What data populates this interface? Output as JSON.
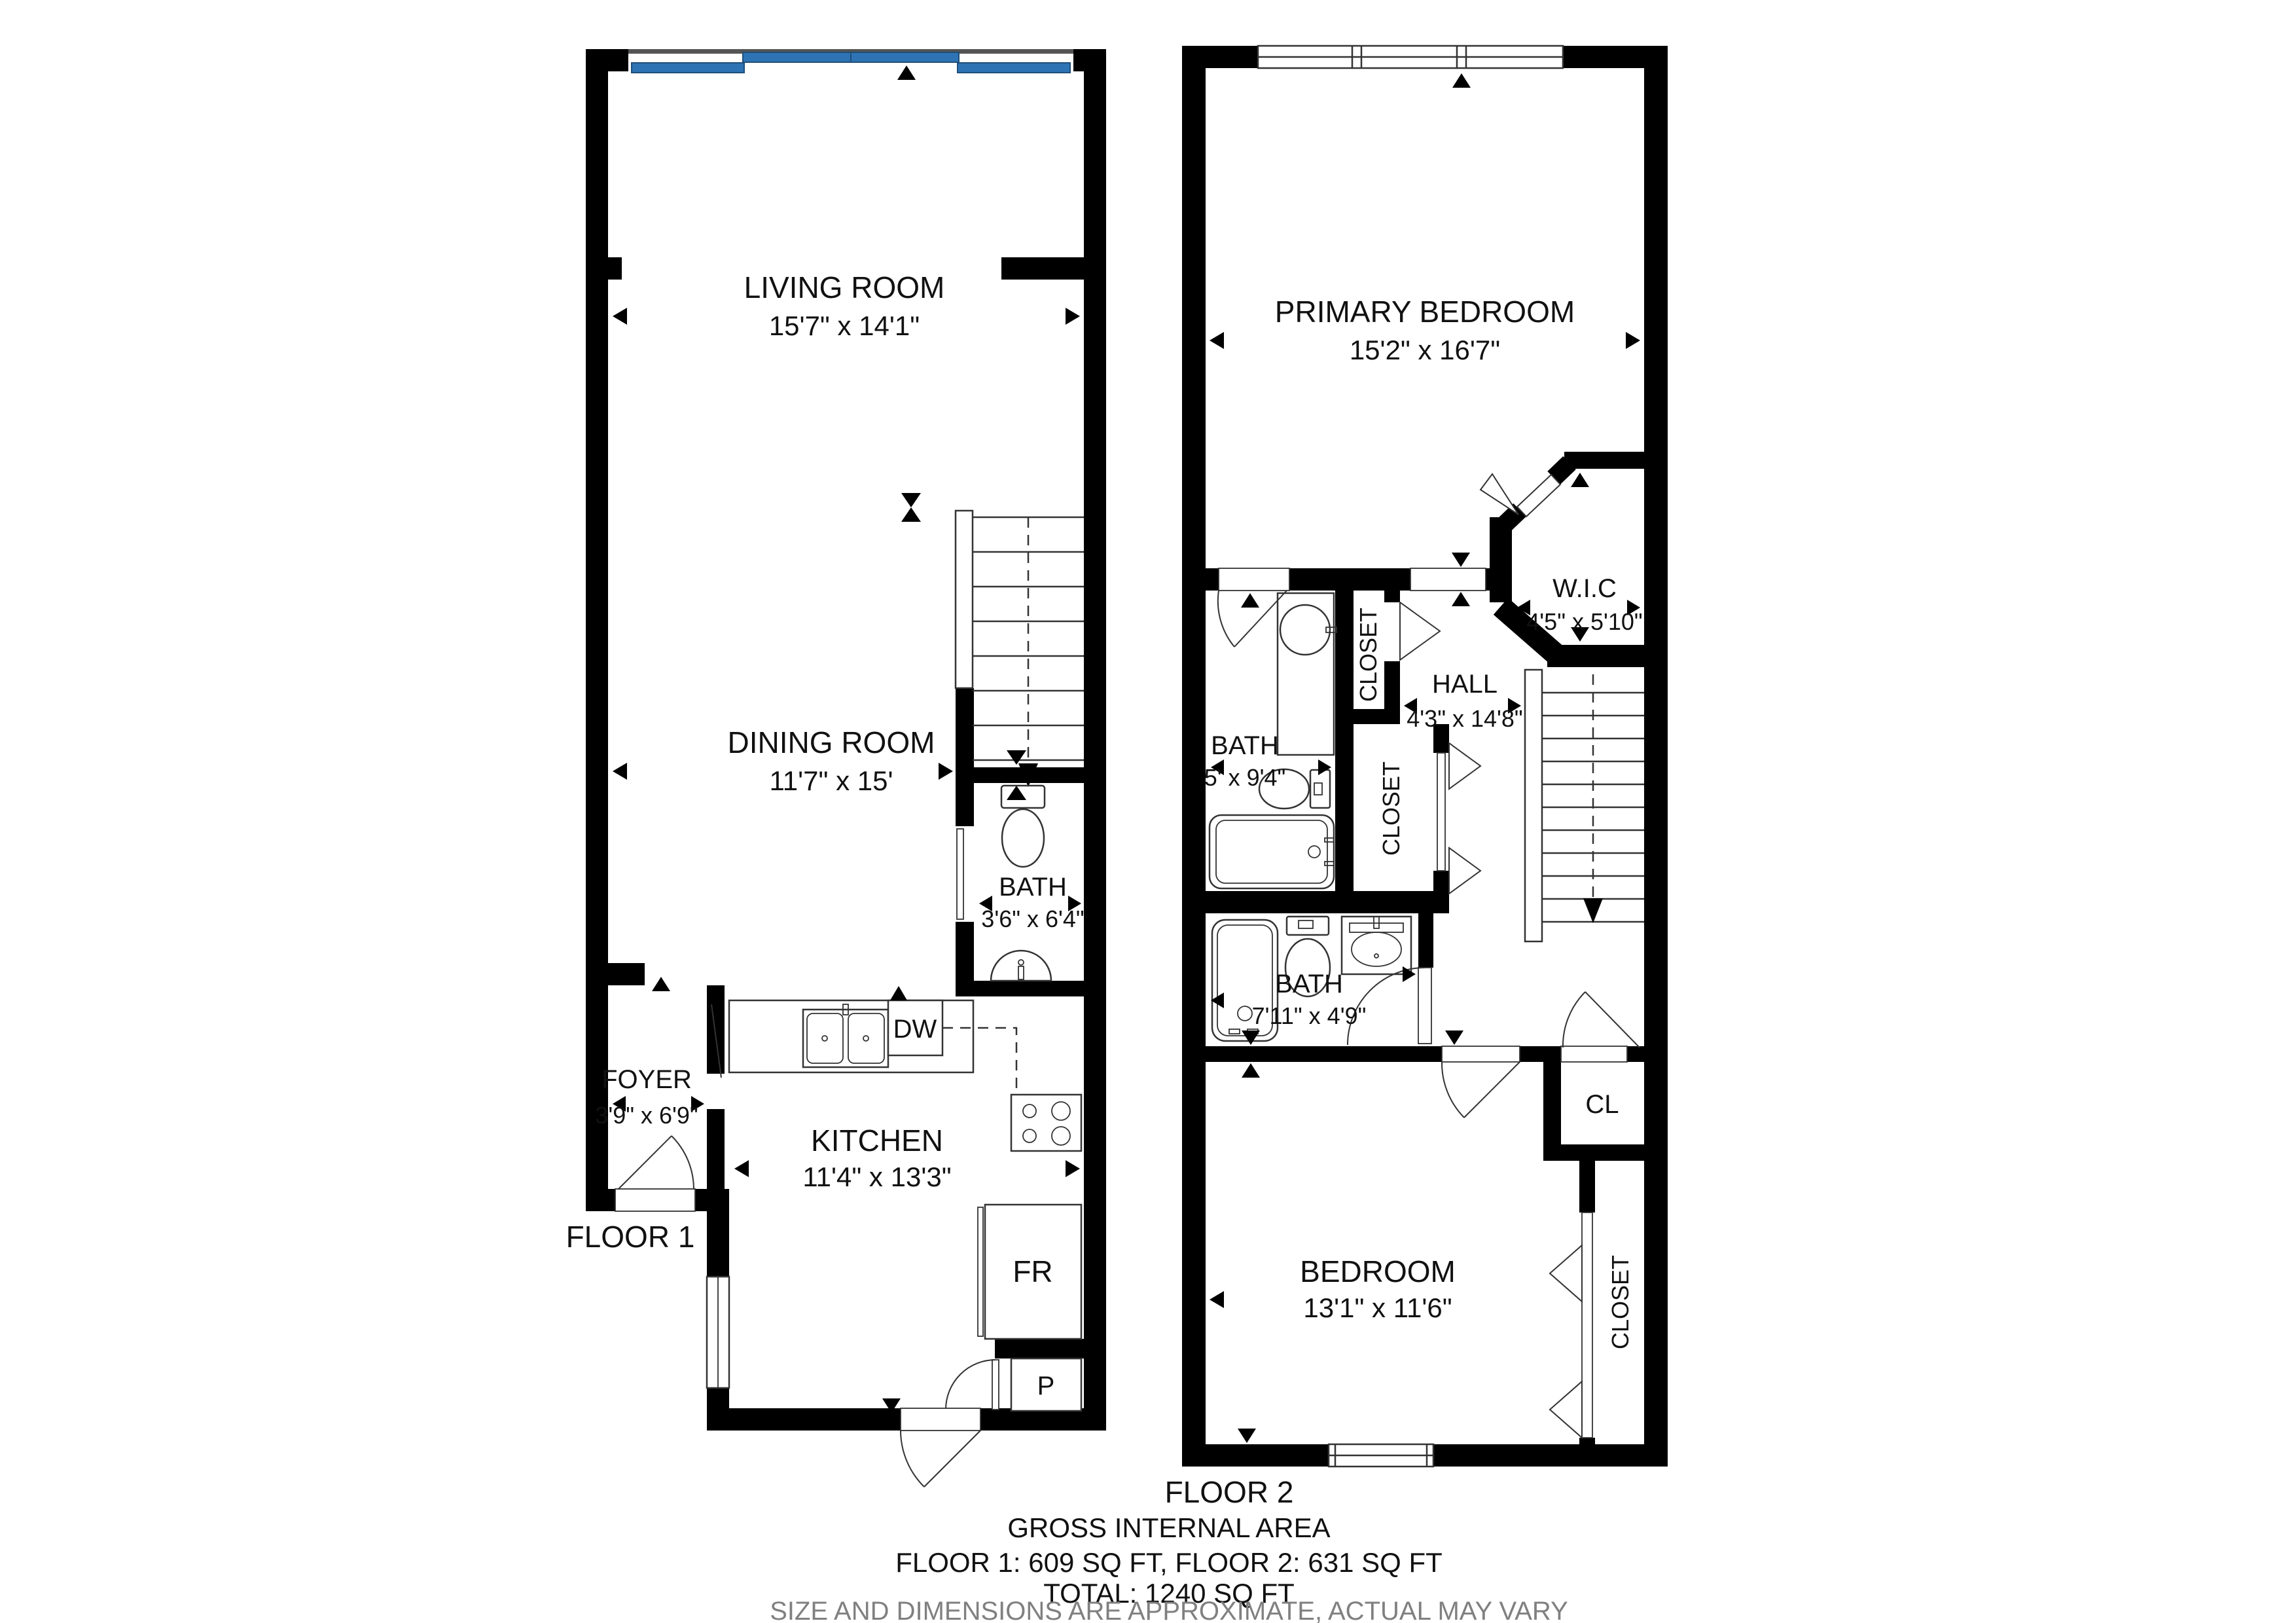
{
  "floor1": {
    "label": "FLOOR 1",
    "rooms": {
      "living": {
        "name": "LIVING ROOM",
        "dims": "15'7\" x 14'1\""
      },
      "dining": {
        "name": "DINING ROOM",
        "dims": "11'7\" x 15'"
      },
      "bath": {
        "name": "BATH",
        "dims": "3'6\" x 6'4\""
      },
      "foyer": {
        "name": "FOYER",
        "dims": "3'9\" x 6'9\""
      },
      "kitchen": {
        "name": "KITCHEN",
        "dims": "11'4\" x 13'3\""
      }
    },
    "appliances": {
      "dishwasher": "DW",
      "fridge": "FR",
      "pantry": "P"
    }
  },
  "floor2": {
    "label": "FLOOR 2",
    "rooms": {
      "primary": {
        "name": "PRIMARY BEDROOM",
        "dims": "15'2\" x 16'7\""
      },
      "wic": {
        "name": "W.I.C",
        "dims": "4'5\" x 5'10\""
      },
      "hall": {
        "name": "HALL",
        "dims": "4'3\" x 14'8\""
      },
      "bath_upper": {
        "name": "BATH",
        "dims": "5' x 9'4\""
      },
      "bath_lower": {
        "name": "BATH",
        "dims": "7'11\" x 4'9\""
      },
      "bedroom": {
        "name": "BEDROOM",
        "dims": "13'1\" x 11'6\""
      },
      "closet_upper": {
        "name": "CLOSET"
      },
      "closet_hall": {
        "name": "CLOSET"
      },
      "cl": {
        "name": "CL"
      },
      "closet_bedroom": {
        "name": "CLOSET"
      }
    }
  },
  "footer": {
    "line1": "GROSS INTERNAL AREA",
    "line2": "FLOOR 1: 609 SQ FT, FLOOR 2: 631 SQ FT",
    "line3": "TOTAL: 1240 SQ FT",
    "line4": "SIZE AND DIMENSIONS ARE APPROXIMATE, ACTUAL MAY VARY"
  },
  "colors": {
    "wall": "#000000",
    "window_glass": "#2E74B5",
    "footer_note": "#808080"
  }
}
